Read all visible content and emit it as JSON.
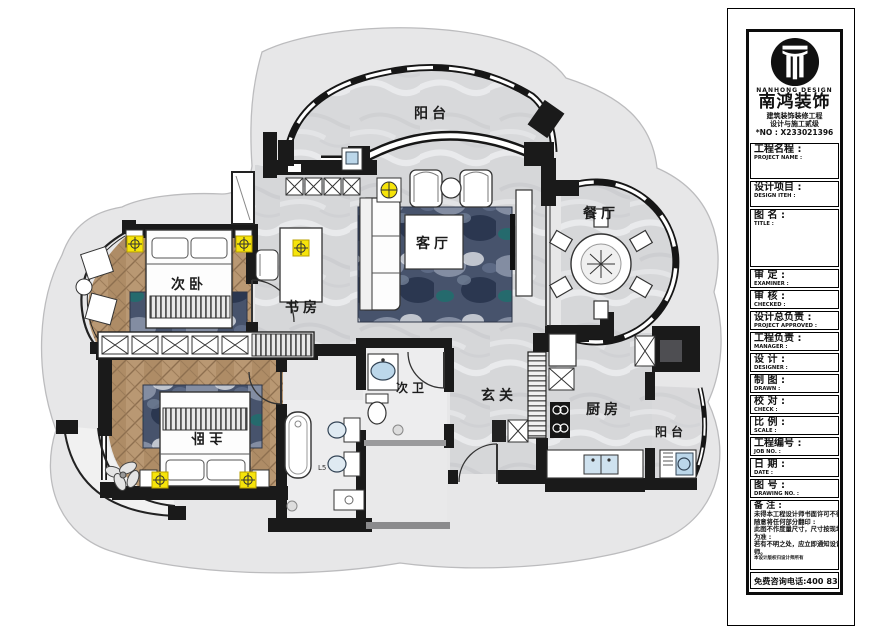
{
  "title_block": {
    "logo": {
      "company_en": "NANHONG DESIGN",
      "company_cn": "南鸿装饰",
      "cert_line1": "建筑装饰装修工程",
      "cert_line2": "设计与施工贰级",
      "license_no": "*NO : X233021396"
    },
    "fields": [
      {
        "cn": "工程名程 :",
        "en": "PROJECT NAME :"
      },
      {
        "cn": "设计项目 :",
        "en": "DESIGN ITEH :"
      },
      {
        "cn": "图 名 :",
        "en": "TITLE :"
      },
      {
        "cn": "审 定 :",
        "en": "EXAMINER :"
      },
      {
        "cn": "审 核 :",
        "en": "CHECKED :"
      },
      {
        "cn": "设计总负责 :",
        "en": "PROJECT APPROVED :"
      },
      {
        "cn": "工程负责 :",
        "en": "MANAGER :"
      },
      {
        "cn": "设 计 :",
        "en": "DESIGNER :"
      },
      {
        "cn": "制 图 :",
        "en": "DRAWN :"
      },
      {
        "cn": "校 对 :",
        "en": "CHECK :"
      },
      {
        "cn": "比 例 :",
        "en": "SCALE :"
      },
      {
        "cn": "工程编号 :",
        "en": "JOB NO. :"
      },
      {
        "cn": "日 期 :",
        "en": "DATE :"
      },
      {
        "cn": "图 号 :",
        "en": "DRAWING NO. :"
      }
    ],
    "notes": {
      "label": "备 注 :",
      "lines": [
        "未得本工程设计师书面许可不得",
        "随意将任何部分翻印 :",
        "此图不作度量尺寸，尺寸按现场",
        "为准 :",
        "若有不明之处，应立即通知设计",
        "师。"
      ],
      "tiny_line": "本设计版权归设计师所有"
    },
    "hotline": "免费咨询电话:400 8383 168"
  },
  "floor_plan": {
    "rooms": {
      "balcony_top": "阳台",
      "living_room": "客厅",
      "dining_room": "餐厅",
      "bedroom_second": "次卧",
      "study": "书房",
      "bathroom_second": "次卫",
      "foyer": "玄关",
      "bedroom_master": "主卧",
      "kitchen": "厨房",
      "balcony_rear": "阳台"
    },
    "annotations": {
      "fixture_label": "L5"
    },
    "colors": {
      "wall": "#1a1a1a",
      "floor_marble": "#d6d7d9",
      "floor_wood": "#b3916c",
      "rug_marble": "#47536c",
      "light_symbol": "#f6e40a",
      "fixture_blue": "#bcd7ea"
    }
  }
}
